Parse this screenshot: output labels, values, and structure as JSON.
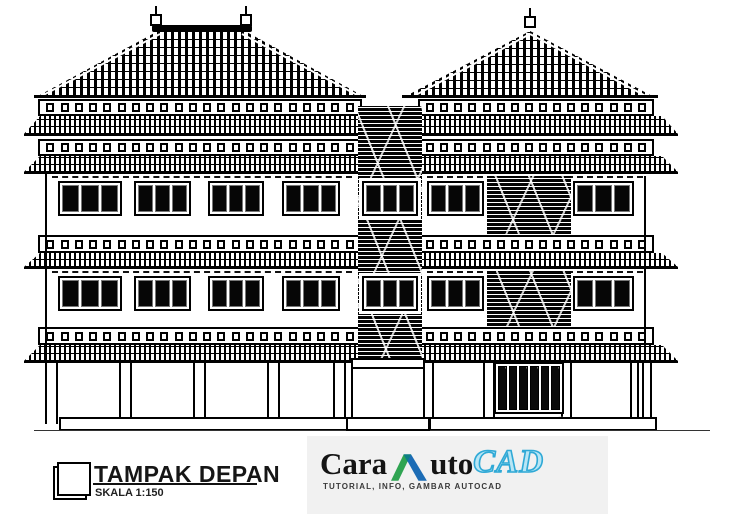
{
  "annotation": {
    "title": "TAMPAK DEPAN",
    "scale_label": "SKALA 1:150"
  },
  "logo": {
    "word_part1": "Cara",
    "word_part2": "uto",
    "word_part3": "CAD",
    "tagline": "TUTORIAL, INFO, GAMBAR AUTOCAD",
    "mark_icon": "autodesk-a-icon",
    "colors": {
      "text": "#141414",
      "mark_green": "#2fa452",
      "mark_blue": "#1c6cb5",
      "cad_fill": "#b9e6f5",
      "cad_outline": "#2fa9d6",
      "backdrop": "#f1f1f1"
    }
  },
  "drawing": {
    "type": "building front elevation, black ink line art",
    "ink": "#000000",
    "paper": "#ffffff",
    "floors": 3,
    "left_wing_window_groups": 4,
    "right_wing_window_groups": 2,
    "tower_window_groups": 2,
    "right_wing_stone_panels": 2,
    "panes_per_window": 3,
    "gate_slats": 6,
    "left_roof_finials": 2,
    "right_roof_finials": 1
  }
}
